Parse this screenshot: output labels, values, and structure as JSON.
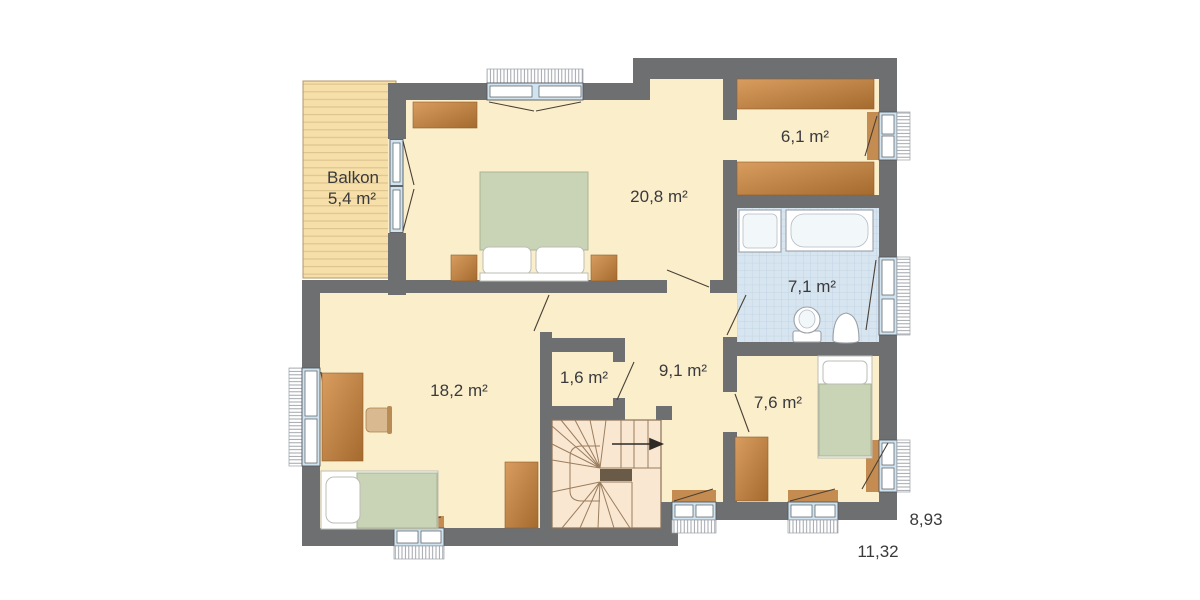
{
  "rooms": {
    "balcony": {
      "name": "Balkon",
      "area": "5,4 m²"
    },
    "bedroom": {
      "area": "20,8 m²"
    },
    "dressing": {
      "area": "6,1 m²"
    },
    "bathroom": {
      "area": "7,1 m²"
    },
    "hallway": {
      "area": "9,1 m²"
    },
    "closet": {
      "area": "1,6 m²"
    },
    "kids_room": {
      "area": "18,2 m²"
    },
    "small_room": {
      "area": "7,6 m²"
    }
  },
  "dimensions": {
    "depth": "8,93",
    "width": "11,32"
  },
  "colors": {
    "wall": "#6e6f71",
    "floor": "#fbeecb",
    "balcony_wood": "#f6dfa9",
    "tile": "#d7e5f0",
    "bed_green": "#c9d3b6",
    "window_blue": "#cfe4f0",
    "sill_brown": "#c48c50",
    "stairs": "#f9e7d2",
    "text": "#3a3a3d"
  }
}
